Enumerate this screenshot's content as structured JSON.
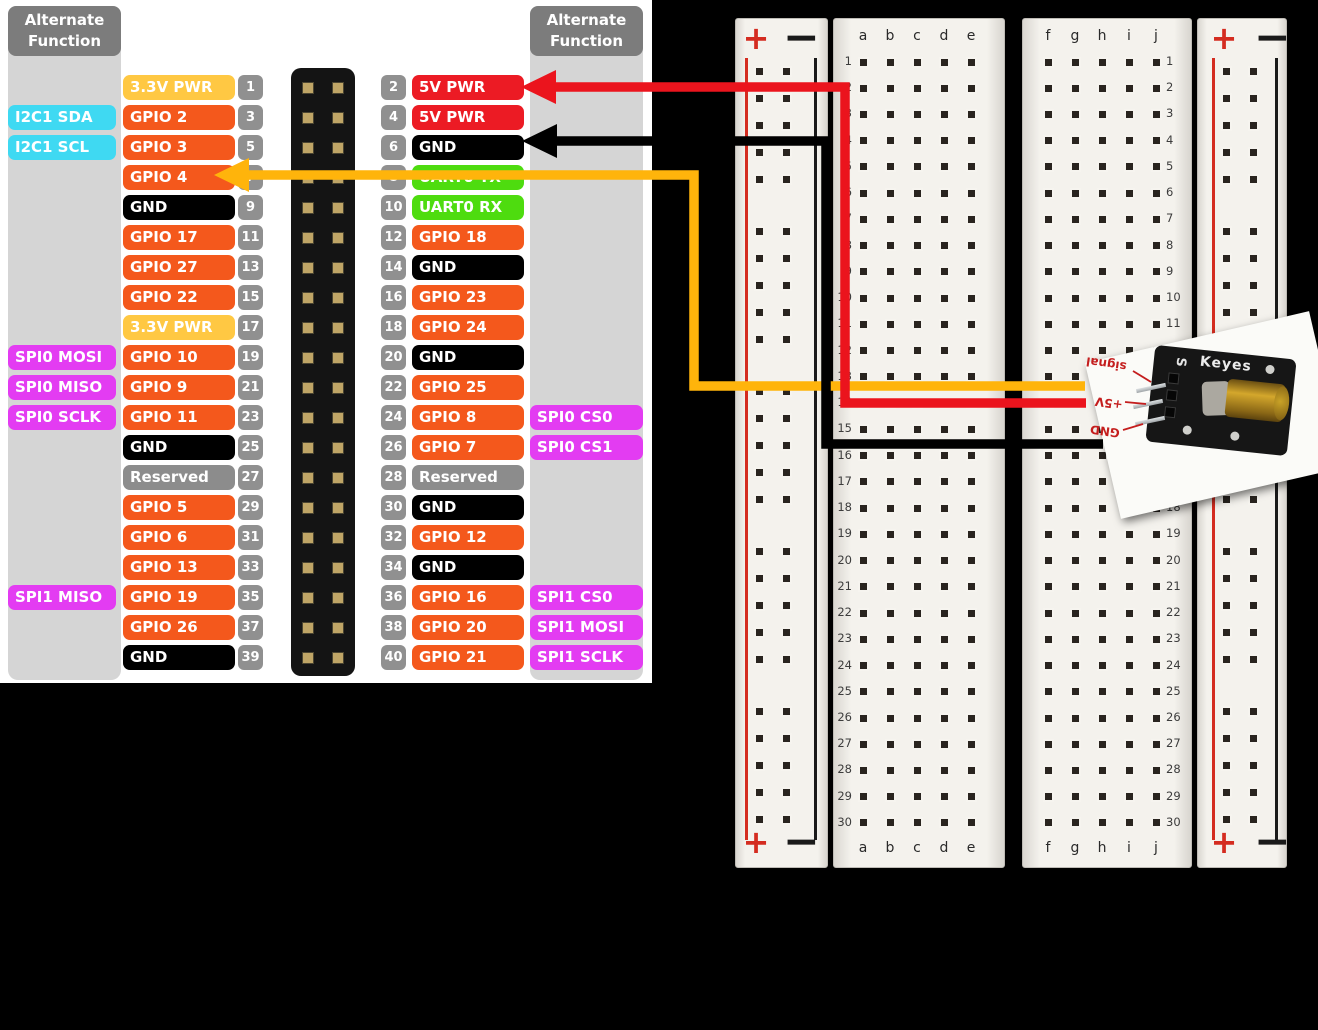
{
  "pinout": {
    "alt_header": {
      "line1": "Alternate",
      "line2": "Function"
    },
    "colors": {
      "gpio": "#F4581C",
      "pwr33": "#FFC843",
      "pwr5v": "#EC1B24",
      "gnd": "#000000",
      "uart": "#4EDC0F",
      "reserved": "#8C8C8C",
      "i2c": "#3FD9F2",
      "spi": "#E33CF2",
      "pin_badge": "#909090"
    },
    "rows": [
      {
        "l_label": "3.3V PWR",
        "l_type": "pwr33",
        "l_pin": "1",
        "r_pin": "2",
        "r_label": "5V PWR",
        "r_type": "pwr5v"
      },
      {
        "l_alt": "I2C1 SDA",
        "l_alt_type": "i2c",
        "l_label": "GPIO 2",
        "l_type": "gpio",
        "l_pin": "3",
        "r_pin": "4",
        "r_label": "5V PWR",
        "r_type": "pwr5v"
      },
      {
        "l_alt": "I2C1 SCL",
        "l_alt_type": "i2c",
        "l_label": "GPIO 3",
        "l_type": "gpio",
        "l_pin": "5",
        "r_pin": "6",
        "r_label": "GND",
        "r_type": "gnd"
      },
      {
        "l_label": "GPIO 4",
        "l_type": "gpio",
        "l_pin": "7",
        "r_pin": "8",
        "r_label": "UART0 TX",
        "r_type": "uart"
      },
      {
        "l_label": "GND",
        "l_type": "gnd",
        "l_pin": "9",
        "r_pin": "10",
        "r_label": "UART0 RX",
        "r_type": "uart"
      },
      {
        "l_label": "GPIO 17",
        "l_type": "gpio",
        "l_pin": "11",
        "r_pin": "12",
        "r_label": "GPIO 18",
        "r_type": "gpio"
      },
      {
        "l_label": "GPIO 27",
        "l_type": "gpio",
        "l_pin": "13",
        "r_pin": "14",
        "r_label": "GND",
        "r_type": "gnd"
      },
      {
        "l_label": "GPIO 22",
        "l_type": "gpio",
        "l_pin": "15",
        "r_pin": "16",
        "r_label": "GPIO 23",
        "r_type": "gpio"
      },
      {
        "l_label": "3.3V PWR",
        "l_type": "pwr33",
        "l_pin": "17",
        "r_pin": "18",
        "r_label": "GPIO 24",
        "r_type": "gpio"
      },
      {
        "l_alt": "SPI0 MOSI",
        "l_alt_type": "spi",
        "l_label": "GPIO 10",
        "l_type": "gpio",
        "l_pin": "19",
        "r_pin": "20",
        "r_label": "GND",
        "r_type": "gnd"
      },
      {
        "l_alt": "SPI0 MISO",
        "l_alt_type": "spi",
        "l_label": "GPIO 9",
        "l_type": "gpio",
        "l_pin": "21",
        "r_pin": "22",
        "r_label": "GPIO 25",
        "r_type": "gpio"
      },
      {
        "l_alt": "SPI0 SCLK",
        "l_alt_type": "spi",
        "l_label": "GPIO 11",
        "l_type": "gpio",
        "l_pin": "23",
        "r_pin": "24",
        "r_label": "GPIO 8",
        "r_type": "gpio",
        "r_alt": "SPI0 CS0",
        "r_alt_type": "spi"
      },
      {
        "l_label": "GND",
        "l_type": "gnd",
        "l_pin": "25",
        "r_pin": "26",
        "r_label": "GPIO 7",
        "r_type": "gpio",
        "r_alt": "SPI0 CS1",
        "r_alt_type": "spi"
      },
      {
        "l_label": "Reserved",
        "l_type": "reserved",
        "l_pin": "27",
        "r_pin": "28",
        "r_label": "Reserved",
        "r_type": "reserved"
      },
      {
        "l_label": "GPIO 5",
        "l_type": "gpio",
        "l_pin": "29",
        "r_pin": "30",
        "r_label": "GND",
        "r_type": "gnd"
      },
      {
        "l_label": "GPIO 6",
        "l_type": "gpio",
        "l_pin": "31",
        "r_pin": "32",
        "r_label": "GPIO 12",
        "r_type": "gpio"
      },
      {
        "l_label": "GPIO 13",
        "l_type": "gpio",
        "l_pin": "33",
        "r_pin": "34",
        "r_label": "GND",
        "r_type": "gnd"
      },
      {
        "l_alt": "SPI1 MISO",
        "l_alt_type": "spi",
        "l_label": "GPIO 19",
        "l_type": "gpio",
        "l_pin": "35",
        "r_pin": "36",
        "r_label": "GPIO 16",
        "r_type": "gpio",
        "r_alt": "SPI1 CS0",
        "r_alt_type": "spi"
      },
      {
        "l_label": "GPIO 26",
        "l_type": "gpio",
        "l_pin": "37",
        "r_pin": "38",
        "r_label": "GPIO 20",
        "r_type": "gpio",
        "r_alt": "SPI1 MOSI",
        "r_alt_type": "spi"
      },
      {
        "l_label": "GND",
        "l_type": "gnd",
        "l_pin": "39",
        "r_pin": "40",
        "r_label": "GPIO 21",
        "r_type": "gpio",
        "r_alt": "SPI1 SCLK",
        "r_alt_type": "spi"
      }
    ]
  },
  "breadboard": {
    "row_count": 30,
    "letters_left": [
      "a",
      "b",
      "c",
      "d",
      "e"
    ],
    "letters_right": [
      "f",
      "g",
      "h",
      "i",
      "j"
    ],
    "rail_plus": "+",
    "rail_minus": "−",
    "rail_red": "#D42C20",
    "rail_black": "#1A1A1A"
  },
  "laser_module": {
    "mark_s": "S",
    "brand": "Keyes",
    "pin_labels": [
      "signal",
      "+5V",
      "GND"
    ]
  },
  "wires": [
    {
      "id": "wire-yellow",
      "color": "#FFB40B",
      "from": "GPIO 4",
      "to": "signal"
    },
    {
      "id": "wire-red",
      "color": "#EB141D",
      "from": "5V PWR",
      "to": "+5V"
    },
    {
      "id": "wire-black",
      "color": "#000000",
      "from": "GND",
      "to": "GND"
    }
  ]
}
